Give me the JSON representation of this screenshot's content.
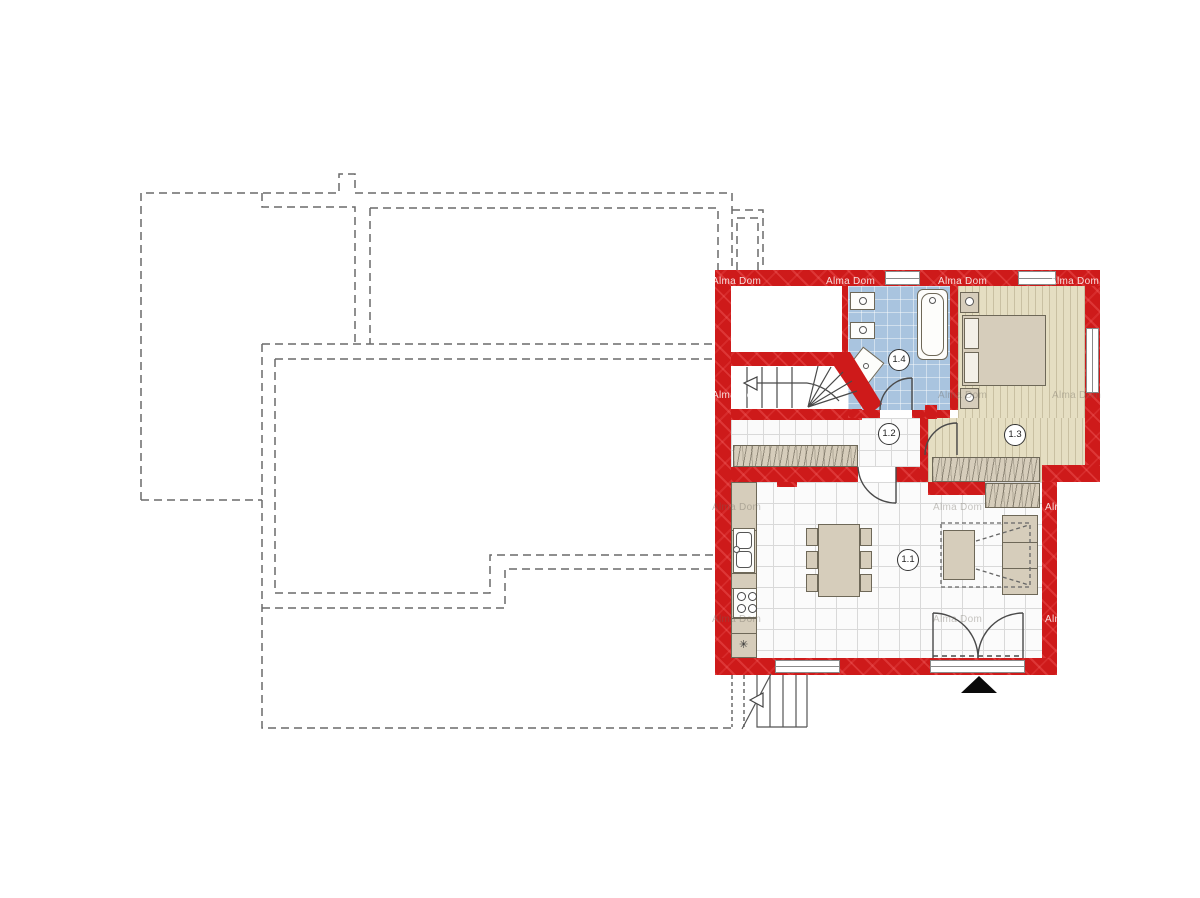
{
  "title": "Ground floor plan",
  "watermark": {
    "text": "Alma Dom"
  },
  "rooms": {
    "living": {
      "label": "1.1"
    },
    "hallway": {
      "label": "1.2"
    },
    "bedroom": {
      "label": "1.3"
    },
    "bathroom": {
      "label": "1.4"
    }
  },
  "colors": {
    "wall_red": "#ce1a1a",
    "bathroom_blue": "#a9c4df",
    "bedroom_floor": "#e5dec2",
    "furniture_beige": "#d6cdbb",
    "tile_line": "#d9d9d9",
    "outline_dashed": "#6a6a6a",
    "entrance_marker": "#0a0a0a"
  }
}
